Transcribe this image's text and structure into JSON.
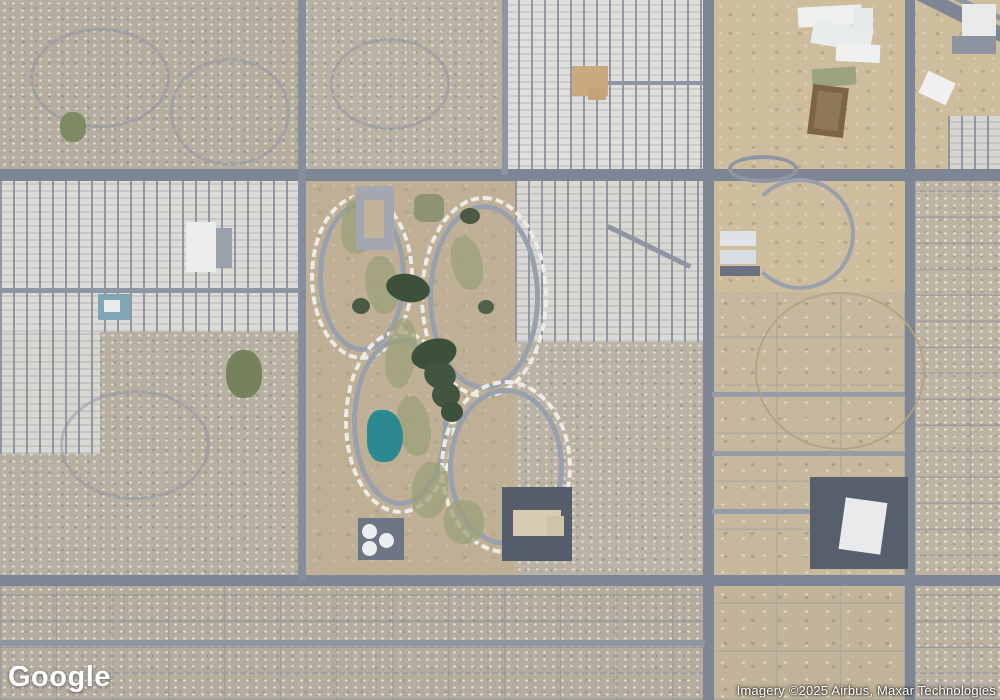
{
  "map": {
    "provider": "Google",
    "view": "satellite",
    "logo_text": "Google",
    "attribution": "Imagery ©2025 Airbus, Maxar Technologies",
    "colors": {
      "road_major": "#7e8695",
      "road_minor": "#8e95a3",
      "desert": "#cdbd9d",
      "residential": "#b5ae9f",
      "mobile_home_white": "#dfdeda",
      "water_teal": "#2b8a8f",
      "pond_dark_green": "#3d503c",
      "fairway_olive": "#9aa077",
      "parking_dark": "#565e6b",
      "building_white": "#eceeed"
    },
    "regions": [
      {
        "name": "desert-northeast",
        "kind": "desert",
        "x": 712,
        "y": 0,
        "w": 288,
        "h": 292,
        "color": "#cdbd9d"
      },
      {
        "name": "residential-northwest",
        "kind": "res",
        "x": 0,
        "y": 0,
        "w": 302,
        "h": 174,
        "color": "#b5ae9f"
      },
      {
        "name": "residential-north-center",
        "kind": "res",
        "x": 302,
        "y": 0,
        "w": 203,
        "h": 174,
        "color": "#b9b2a3"
      },
      {
        "name": "mobile-home-park-north",
        "kind": "mhp",
        "x": 505,
        "y": 0,
        "w": 200,
        "h": 174,
        "color": "#dfdeda"
      },
      {
        "name": "mobile-home-park-west",
        "kind": "mhp",
        "x": 0,
        "y": 174,
        "w": 302,
        "h": 158,
        "color": "#dcdbd5"
      },
      {
        "name": "residential-west",
        "kind": "res",
        "x": 0,
        "y": 332,
        "w": 302,
        "h": 250,
        "color": "#b7afa0"
      },
      {
        "name": "mobile-home-curves-west",
        "kind": "mhp",
        "x": 0,
        "y": 332,
        "w": 100,
        "h": 122,
        "color": "#d8d7d1"
      },
      {
        "name": "golf-community",
        "kind": "golf",
        "x": 305,
        "y": 178,
        "w": 210,
        "h": 400,
        "color": "#bfb095"
      },
      {
        "name": "mobile-home-blocks-east",
        "kind": "mhp",
        "x": 515,
        "y": 178,
        "w": 192,
        "h": 164,
        "color": "#d9d8d2"
      },
      {
        "name": "residential-center-south",
        "kind": "res",
        "x": 515,
        "y": 342,
        "w": 192,
        "h": 236,
        "color": "#bab2a3"
      },
      {
        "name": "residential-far-right",
        "kind": "res-grid",
        "x": 914,
        "y": 174,
        "w": 86,
        "h": 408,
        "color": "#bdb3a2"
      },
      {
        "name": "rural-east",
        "kind": "rural",
        "x": 712,
        "y": 292,
        "w": 193,
        "h": 286,
        "color": "#c6b89d"
      },
      {
        "name": "residential-south",
        "kind": "res-grid",
        "x": 0,
        "y": 586,
        "w": 707,
        "h": 114,
        "color": "#b4ad9e"
      },
      {
        "name": "rural-south-center",
        "kind": "rural",
        "x": 712,
        "y": 586,
        "w": 193,
        "h": 114,
        "color": "#c2b49a"
      },
      {
        "name": "residential-south-east",
        "kind": "res-grid",
        "x": 914,
        "y": 586,
        "w": 86,
        "h": 114,
        "color": "#bab1a1"
      },
      {
        "name": "rv-storage-northeast",
        "kind": "mhp",
        "x": 948,
        "y": 116,
        "w": 52,
        "h": 56,
        "color": "#d6d5d0"
      }
    ],
    "roads": [
      {
        "name": "road-horizontal-north",
        "x": 0,
        "y": 169,
        "w": 1000,
        "h": 12,
        "color": "#7e8695"
      },
      {
        "name": "road-horizontal-south",
        "x": 0,
        "y": 575,
        "w": 1000,
        "h": 11,
        "color": "#7e8695"
      },
      {
        "name": "road-vertical-center",
        "x": 703,
        "y": 0,
        "w": 11,
        "h": 700,
        "color": "#7e8695"
      },
      {
        "name": "road-vertical-east",
        "x": 905,
        "y": 0,
        "w": 10,
        "h": 700,
        "color": "#7e8695"
      },
      {
        "name": "road-arterial-west",
        "x": 298,
        "y": 0,
        "w": 8,
        "h": 581,
        "color": "#868d9b"
      },
      {
        "name": "street-vertical-505",
        "x": 502,
        "y": 0,
        "w": 6,
        "h": 175,
        "color": "#8e95a3"
      },
      {
        "name": "street-horizontal-mhp-north",
        "x": 590,
        "y": 81,
        "w": 113,
        "h": 4,
        "color": "#8e95a3"
      },
      {
        "name": "street-horizontal-mhp-west",
        "x": 0,
        "y": 288,
        "w": 300,
        "h": 5,
        "color": "#8e95a3"
      },
      {
        "name": "street-horizontal-south",
        "x": 0,
        "y": 640,
        "w": 705,
        "h": 6,
        "color": "#8e95a3"
      },
      {
        "name": "street-rural-1",
        "x": 712,
        "y": 392,
        "w": 193,
        "h": 5,
        "color": "#969da9"
      },
      {
        "name": "street-rural-2",
        "x": 712,
        "y": 451,
        "w": 193,
        "h": 5,
        "color": "#969da9"
      },
      {
        "name": "street-rural-3",
        "x": 712,
        "y": 509,
        "w": 193,
        "h": 5,
        "color": "#969da9"
      },
      {
        "name": "highway-diagonal",
        "x": 824,
        "y": -8,
        "w": 212,
        "h": 14,
        "rot": 26.5,
        "color": "#7e8695"
      },
      {
        "name": "frontage-diagonal",
        "x": 876,
        "y": -6,
        "w": 152,
        "h": 5,
        "rot": 24,
        "color": "#8e95a3"
      },
      {
        "name": "street-diagonal-mhp-east",
        "x": 603,
        "y": 244,
        "w": 92,
        "h": 5,
        "rot": 26,
        "color": "#8e95a3"
      }
    ],
    "features": [
      {
        "name": "traffic-loop-ring",
        "kind": "ring",
        "x": 728,
        "y": 155,
        "w": 70,
        "h": 28,
        "bw": 4,
        "color": "#8e95a3"
      },
      {
        "name": "desert-curve-road",
        "kind": "arc",
        "x": 745,
        "y": 178,
        "w": 110,
        "h": 112,
        "bw": 4,
        "sides": "trb",
        "color": "#9aa0ac"
      },
      {
        "name": "desert-dirt-circle",
        "kind": "ring",
        "x": 755,
        "y": 292,
        "w": 170,
        "h": 158,
        "bw": 2,
        "color": "rgba(176,162,130,0.9)"
      },
      {
        "name": "curvy-street-nw-1",
        "kind": "ring",
        "x": 30,
        "y": 28,
        "w": 140,
        "h": 100,
        "bw": 3,
        "color": "rgba(140,148,162,0.55)"
      },
      {
        "name": "curvy-street-nw-2",
        "kind": "ring",
        "x": 170,
        "y": 58,
        "w": 120,
        "h": 108,
        "bw": 3,
        "color": "rgba(140,148,162,0.5)"
      },
      {
        "name": "curvy-street-nc",
        "kind": "ring",
        "x": 330,
        "y": 38,
        "w": 120,
        "h": 92,
        "bw": 3,
        "color": "rgba(140,148,162,0.5)"
      },
      {
        "name": "curvy-street-west",
        "kind": "ring",
        "x": 60,
        "y": 390,
        "w": 150,
        "h": 110,
        "bw": 3,
        "color": "rgba(140,148,162,0.5)"
      },
      {
        "name": "trailer-loop-1",
        "kind": "ring",
        "x": 310,
        "y": 194,
        "w": 104,
        "h": 166,
        "bw": 4,
        "bs": "dashed",
        "color": "#ecebe5"
      },
      {
        "name": "golf-street-loop-1",
        "kind": "ring",
        "x": 318,
        "y": 202,
        "w": 88,
        "h": 150,
        "bw": 5,
        "color": "#99a0ad"
      },
      {
        "name": "trailer-loop-2",
        "kind": "ring",
        "x": 344,
        "y": 330,
        "w": 112,
        "h": 184,
        "bw": 4,
        "bs": "dashed",
        "color": "#ecebe5"
      },
      {
        "name": "golf-street-loop-2",
        "kind": "ring",
        "x": 352,
        "y": 338,
        "w": 96,
        "h": 168,
        "bw": 5,
        "color": "#99a0ad"
      },
      {
        "name": "trailer-loop-3",
        "kind": "ring",
        "x": 420,
        "y": 196,
        "w": 128,
        "h": 202,
        "bw": 4,
        "bs": "dashed",
        "color": "#ecebe5"
      },
      {
        "name": "golf-street-loop-3",
        "kind": "ring",
        "x": 428,
        "y": 204,
        "w": 112,
        "h": 186,
        "bw": 5,
        "color": "#99a0ad"
      },
      {
        "name": "trailer-loop-4",
        "kind": "ring",
        "x": 440,
        "y": 380,
        "w": 132,
        "h": 174,
        "bw": 4,
        "bs": "dashed",
        "color": "#ecebe5"
      },
      {
        "name": "golf-street-loop-4",
        "kind": "ring",
        "x": 448,
        "y": 388,
        "w": 116,
        "h": 158,
        "bw": 5,
        "color": "#99a0ad"
      },
      {
        "name": "fairway-patch-1",
        "x": 342,
        "y": 192,
        "w": 36,
        "h": 62,
        "rot": 12,
        "r": "45%",
        "o": 0.7,
        "color": "#9aa077"
      },
      {
        "name": "fairway-patch-2",
        "x": 366,
        "y": 256,
        "w": 32,
        "h": 58,
        "rot": -8,
        "r": "45%",
        "o": 0.7,
        "color": "#9aa077"
      },
      {
        "name": "fairway-patch-3",
        "x": 386,
        "y": 318,
        "w": 30,
        "h": 70,
        "rot": 6,
        "r": "45%",
        "o": 0.7,
        "color": "#9aa077"
      },
      {
        "name": "fairway-patch-4",
        "x": 398,
        "y": 396,
        "w": 32,
        "h": 60,
        "rot": -10,
        "r": "45%",
        "o": 0.7,
        "color": "#9aa077"
      },
      {
        "name": "fairway-patch-5",
        "x": 412,
        "y": 462,
        "w": 36,
        "h": 56,
        "rot": 8,
        "r": "45%",
        "o": 0.7,
        "color": "#9aa077"
      },
      {
        "name": "fairway-patch-6",
        "x": 444,
        "y": 500,
        "w": 40,
        "h": 44,
        "rot": -6,
        "r": "45%",
        "o": 0.7,
        "color": "#9aa077"
      },
      {
        "name": "fairway-patch-7",
        "x": 452,
        "y": 236,
        "w": 30,
        "h": 54,
        "rot": -12,
        "r": "45%",
        "o": 0.7,
        "color": "#9aa077"
      },
      {
        "name": "golf-pond-1",
        "x": 411,
        "y": 339,
        "w": 46,
        "h": 30,
        "rot": -15,
        "r": "50%",
        "color": "#3d503c"
      },
      {
        "name": "golf-pond-2",
        "x": 424,
        "y": 361,
        "w": 32,
        "h": 28,
        "rot": 20,
        "r": "50%",
        "color": "#42553f"
      },
      {
        "name": "golf-pond-3",
        "x": 386,
        "y": 274,
        "w": 44,
        "h": 28,
        "rot": 10,
        "r": "50%",
        "color": "#3d503c"
      },
      {
        "name": "golf-pond-4",
        "x": 432,
        "y": 382,
        "w": 28,
        "h": 26,
        "r": "50%",
        "color": "#42553f"
      },
      {
        "name": "golf-pond-5",
        "x": 441,
        "y": 402,
        "w": 22,
        "h": 20,
        "r": "50%",
        "color": "#3d503c"
      },
      {
        "name": "tree-cluster-1",
        "x": 352,
        "y": 298,
        "w": 18,
        "h": 16,
        "r": "50%",
        "color": "#4a5a44"
      },
      {
        "name": "tree-cluster-2",
        "x": 460,
        "y": 208,
        "w": 20,
        "h": 16,
        "r": "50%",
        "color": "#4a5a44"
      },
      {
        "name": "tree-cluster-3",
        "x": 478,
        "y": 300,
        "w": 16,
        "h": 14,
        "r": "50%",
        "color": "#50604a"
      },
      {
        "name": "teal-lake",
        "x": 367,
        "y": 410,
        "w": 36,
        "h": 52,
        "r": "40% 60% 55% 45%",
        "color": "#2b8a8f"
      },
      {
        "name": "tank-pad",
        "x": 358,
        "y": 518,
        "w": 46,
        "h": 42,
        "color": "#6e7683"
      },
      {
        "name": "storage-tank-1",
        "x": 362,
        "y": 524,
        "w": 15,
        "h": 15,
        "r": "50%",
        "color": "#eceff0"
      },
      {
        "name": "storage-tank-2",
        "x": 379,
        "y": 533,
        "w": 15,
        "h": 15,
        "r": "50%",
        "color": "#eceff0"
      },
      {
        "name": "storage-tank-3",
        "x": 362,
        "y": 541,
        "w": 15,
        "h": 15,
        "r": "50%",
        "color": "#eceff0"
      },
      {
        "name": "apartment-complex-building",
        "x": 356,
        "y": 186,
        "w": 38,
        "h": 64,
        "color": "#a3a8b0"
      },
      {
        "name": "apartment-courtyard",
        "x": 364,
        "y": 200,
        "w": 20,
        "h": 38,
        "color": "#c2b49a"
      },
      {
        "name": "park-green-1",
        "x": 226,
        "y": 350,
        "w": 36,
        "h": 48,
        "r": "45%",
        "color": "#75825c"
      },
      {
        "name": "park-green-2",
        "x": 414,
        "y": 194,
        "w": 30,
        "h": 28,
        "r": "30%",
        "color": "#8d9474"
      },
      {
        "name": "park-green-northwest",
        "x": 60,
        "y": 112,
        "w": 26,
        "h": 30,
        "r": "45%",
        "color": "#7d8a63"
      },
      {
        "name": "clubhouse-north",
        "x": 572,
        "y": 66,
        "w": 36,
        "h": 30,
        "color": "#c9aa7d"
      },
      {
        "name": "clubhouse-north-annex",
        "x": 588,
        "y": 88,
        "w": 18,
        "h": 12,
        "color": "#c2a478"
      },
      {
        "name": "rec-center-west-pool-roof",
        "x": 98,
        "y": 294,
        "w": 32,
        "h": 26,
        "color": "#7fa6b5"
      },
      {
        "name": "rec-center-west-building",
        "x": 104,
        "y": 300,
        "w": 16,
        "h": 12,
        "color": "#e9ebea"
      },
      {
        "name": "commercial-west-building",
        "x": 186,
        "y": 222,
        "w": 30,
        "h": 50,
        "color": "#eceeed"
      },
      {
        "name": "commercial-west-parking",
        "x": 216,
        "y": 228,
        "w": 16,
        "h": 40,
        "color": "#9ba1ac"
      },
      {
        "name": "school-ne-building-1",
        "x": 798,
        "y": 6,
        "w": 64,
        "h": 20,
        "rot": -3,
        "color": "#eef0ef"
      },
      {
        "name": "school-ne-building-2",
        "x": 812,
        "y": 24,
        "w": 60,
        "h": 24,
        "rot": 10,
        "color": "#e9ecec"
      },
      {
        "name": "school-ne-building-3",
        "x": 836,
        "y": 44,
        "w": 44,
        "h": 18,
        "rot": 3,
        "color": "#eff1f0"
      },
      {
        "name": "school-ne-building-4",
        "x": 853,
        "y": 8,
        "w": 20,
        "h": 26,
        "color": "#e7eaea"
      },
      {
        "name": "school-ne-sports-field",
        "x": 812,
        "y": 68,
        "w": 44,
        "h": 18,
        "rot": -4,
        "color": "#9aa37b"
      },
      {
        "name": "dirt-ballfield",
        "x": 810,
        "y": 86,
        "w": 36,
        "h": 50,
        "rot": 7,
        "color": "#7b6546"
      },
      {
        "name": "dirt-ballfield-infield",
        "x": 816,
        "y": 92,
        "w": 24,
        "h": 38,
        "rot": 7,
        "color": "#8f7858"
      },
      {
        "name": "ne-commercial-building",
        "x": 962,
        "y": 4,
        "w": 34,
        "h": 32,
        "color": "#e9ebea"
      },
      {
        "name": "ne-commercial-parking",
        "x": 952,
        "y": 36,
        "w": 44,
        "h": 18,
        "color": "#8d94a0"
      },
      {
        "name": "ne-commercial-building-2",
        "x": 922,
        "y": 76,
        "w": 30,
        "h": 24,
        "rot": 25,
        "color": "#eff0ef"
      },
      {
        "name": "apartments-east-building-1",
        "x": 720,
        "y": 231,
        "w": 36,
        "h": 15,
        "color": "#dfe3e6"
      },
      {
        "name": "apartments-east-building-2",
        "x": 720,
        "y": 250,
        "w": 36,
        "h": 14,
        "color": "#d8dde0"
      },
      {
        "name": "apartments-east-parking",
        "x": 720,
        "y": 266,
        "w": 40,
        "h": 10,
        "color": "#6a7280"
      },
      {
        "name": "school-mid-parking",
        "x": 502,
        "y": 487,
        "w": 70,
        "h": 74,
        "color": "#565e6b"
      },
      {
        "name": "school-mid-building",
        "x": 513,
        "y": 510,
        "w": 48,
        "h": 26,
        "color": "#d6ccb4"
      },
      {
        "name": "school-mid-wing",
        "x": 546,
        "y": 516,
        "w": 18,
        "h": 20,
        "color": "#cfc4a8"
      },
      {
        "name": "retail-parking-lot",
        "x": 810,
        "y": 477,
        "w": 98,
        "h": 92,
        "color": "#575f6d"
      },
      {
        "name": "retail-store-building",
        "x": 842,
        "y": 500,
        "w": 42,
        "h": 52,
        "rot": 8,
        "color": "#e8eaeb"
      }
    ]
  }
}
